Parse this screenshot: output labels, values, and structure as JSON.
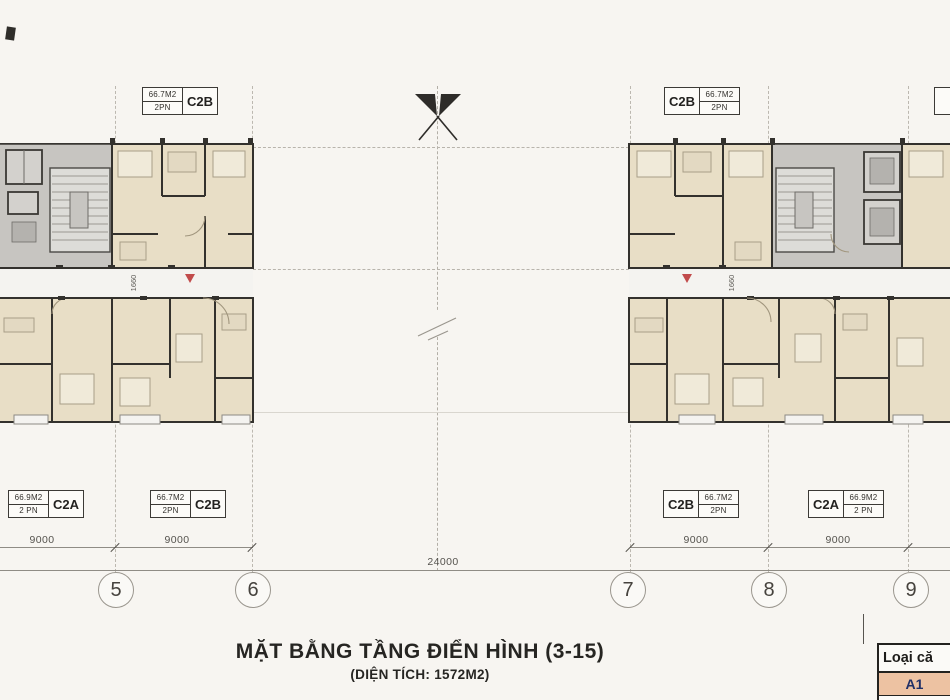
{
  "drawing": {
    "title": "MẶT BẰNG TẦNG ĐIỂN HÌNH (3-15)",
    "subtitle": "(DIỆN TÍCH: 1572M2)"
  },
  "unit_labels": {
    "top_left": {
      "area": "66.7M2",
      "bedrooms": "2PN",
      "code": "C2B"
    },
    "top_right": {
      "area": "66.7M2",
      "bedrooms": "2PN",
      "code": "C2B"
    },
    "bottom_left_1": {
      "area": "66.9M2",
      "bedrooms": "2 PN",
      "code": "C2A"
    },
    "bottom_left_2": {
      "area": "66.7M2",
      "bedrooms": "2PN",
      "code": "C2B"
    },
    "bottom_right_1": {
      "area": "66.7M2",
      "bedrooms": "2PN",
      "code": "C2B"
    },
    "bottom_right_2": {
      "area": "66.9M2",
      "bedrooms": "2 PN",
      "code": "C2A"
    }
  },
  "dimensions": {
    "segments": [
      "9000",
      "9000",
      "24000",
      "9000",
      "9000"
    ],
    "corridor_left": "1660",
    "corridor_right": "1660"
  },
  "grid_bubbles": [
    "5",
    "6",
    "7",
    "8",
    "9"
  ],
  "legend": {
    "header": "Loại că",
    "rows": [
      {
        "label": "A1",
        "bg": "#edc2a2"
      },
      {
        "label": "C2A",
        "bg": "#fbfaf7"
      }
    ]
  },
  "colors": {
    "apartment_fill": "#e8dec6",
    "core_fill": "#c7c5c1",
    "wall": "#33312d",
    "corridor_marker_red": "#c14b4b",
    "legend_a1_bg": "#edc2a2",
    "legend_text_navy": "#203067"
  }
}
